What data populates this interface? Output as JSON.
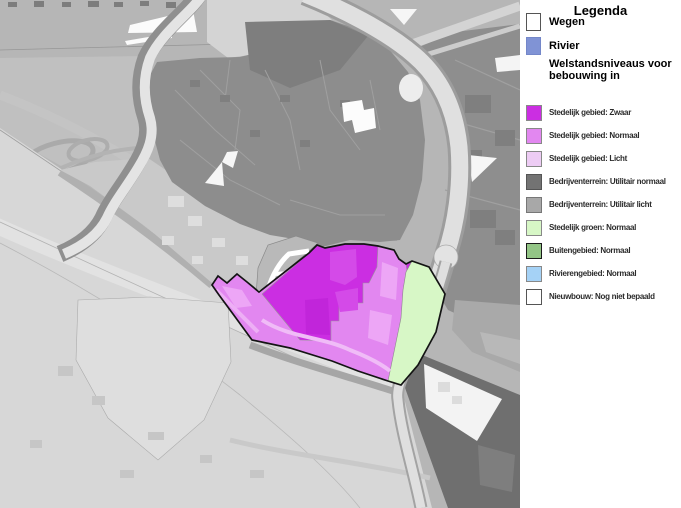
{
  "legend": {
    "title": "Legenda",
    "section_header": "Welstandsniveaus voor bebouwing in",
    "top_items": [
      {
        "key": "wegen",
        "label": "Wegen",
        "color": "#ffffff",
        "border": "#555555"
      },
      {
        "key": "rivier",
        "label": "Rivier",
        "color": "#8093d5",
        "border": "#7487c9"
      }
    ],
    "items": [
      {
        "key": "zwaar",
        "label": "Stedelijk gebied: Zwaar",
        "color": "#cb2ee2",
        "border": "#888888"
      },
      {
        "key": "normaal",
        "label": "Stedelijk gebied: Normaal",
        "color": "#e287f0",
        "border": "#888888"
      },
      {
        "key": "licht",
        "label": "Stedelijk gebied: Licht",
        "color": "#edccf4",
        "border": "#888888"
      },
      {
        "key": "bedrijven_normaal",
        "label": "Bedrijventerrein: Utilitair normaal",
        "color": "#737373",
        "border": "#555555"
      },
      {
        "key": "bedrijven_licht",
        "label": "Bedrijventerrein: Utilitair licht",
        "color": "#a8a8a8",
        "border": "#777777"
      },
      {
        "key": "groen",
        "label": "Stedelijk groen: Normaal",
        "color": "#d7f7c6",
        "border": "#888888"
      },
      {
        "key": "buitengebied",
        "label": "Buitengebied: Normaal",
        "color": "#93c586",
        "border": "#1a1a1a"
      },
      {
        "key": "rivierengebied",
        "label": "Rivierengebied: Normaal",
        "color": "#a5d2f6",
        "border": "#888888"
      },
      {
        "key": "nieuwbouw",
        "label": "Nieuwbouw: Nog niet bepaald",
        "color": "#ffffff",
        "border": "#555555"
      }
    ]
  },
  "map": {
    "highlighted_area_keys": [
      "zwaar",
      "normaal",
      "groen"
    ]
  }
}
